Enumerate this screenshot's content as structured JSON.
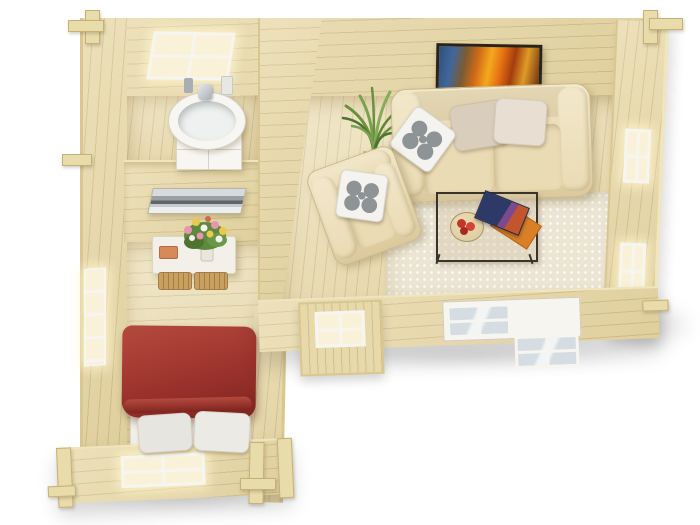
{
  "scene": {
    "type": "3d-floor-plan-render",
    "building": "log-cabin-interior-top-view",
    "rooms": [
      {
        "name": "bathroom",
        "objects": [
          "window",
          "washbasin",
          "vanity-cabinet",
          "faucet",
          "toiletries"
        ]
      },
      {
        "name": "bedroom",
        "objects": [
          "seascape-picture",
          "console-table",
          "wicker-baskets",
          "gift-box",
          "flower-bouquet",
          "double-bed",
          "red-duvet",
          "pillows",
          "side-window",
          "front-window"
        ]
      },
      {
        "name": "living-room",
        "objects": [
          "abstract-painting",
          "three-seat-sofa",
          "beige-cushions",
          "floral-cushions",
          "armchair",
          "potted-yucca",
          "shag-rug",
          "glass-coffee-table",
          "fruit-bowl",
          "magazines",
          "entrance-door",
          "double-window",
          "side-windows"
        ]
      }
    ]
  },
  "palette": {
    "background": "#ffffff",
    "wood_wall": "#e7d9a9",
    "wood_wall_light": "#f0e5bd",
    "wood_wall_dark": "#d9c691",
    "wood_floor": "#ebdfb4",
    "plank_line": "rgba(150,118,54,0.26)",
    "wood_post": "#e9dcab",
    "post_border": "#c6b077",
    "sofa_light": "#f2e8ca",
    "sofa_mid": "#e9dbb4",
    "sofa_dark": "#dcc99c",
    "sofa_border": "#cbb98e",
    "cushion_beige": "#d9cdbb",
    "cushion_cream": "#e8dfd2",
    "pillow_white": "#f4f3ef",
    "floral_gray": "#8e9396",
    "duvet_red": "#a23730",
    "duvet_red_dark": "#7e231e",
    "duvet_red_light": "#b44a3e",
    "mattress_white": "#f1efe9",
    "pillow_gray": "#e7e5df",
    "rug_cream": "#ece5d4",
    "glass_warm": "#faf2d8",
    "glass_cool": "#d5dde2",
    "glass_cool_hi": "#f2f5f6",
    "frame_white": "#f6f5f0",
    "painting_frame": "#2a2319",
    "basket": "#c8a160",
    "basket_line": "#a27e44",
    "plant_green": "#6b9040",
    "plant_green_dark": "#4f7330",
    "pot_tan": "#c9a668",
    "fruit_red": "#c23527",
    "bowl_tan": "#dfcfa4",
    "magazine_navy": "#2d3a68",
    "magazine_orange": "#d97f26",
    "table_frame_dark": "#3a332b",
    "ceramic_white": "#f7f6f2",
    "metal_gray": "#a9aeb4",
    "picture_gray_a": "#d8dbdd",
    "picture_gray_b": "#5f666b",
    "shadow_soft": "rgba(0,0,0,0.14)"
  }
}
